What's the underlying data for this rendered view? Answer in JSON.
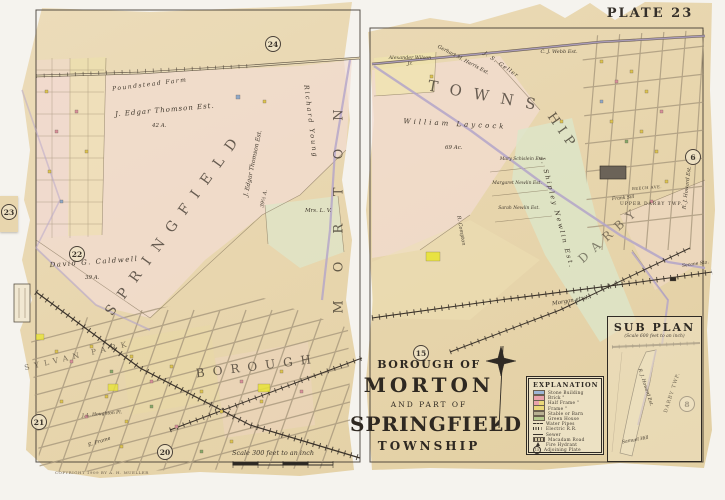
{
  "plate_label": "PLATE 23",
  "adjoining_plates": {
    "top": "24",
    "left_upper": "23",
    "left_mid": "22",
    "left_lower": "21",
    "bottom": "20",
    "center": "15",
    "right": "6",
    "subplan": "8"
  },
  "title_block": {
    "prefix": "BOROUGH OF",
    "name": "MORTON",
    "connector": "AND PART OF",
    "name2": "SPRINGFIELD",
    "suffix": "TOWNSHIP"
  },
  "scale_bar": {
    "label": "Scale 300 feet to an inch"
  },
  "copyright_line": "COPYRIGHT 1909 BY A. H. MUELLER",
  "legend": {
    "title": "EXPLANATION",
    "sample_plate": "15",
    "swatch_colors": {
      "stone": "#9db6d6",
      "brick": "#e9a3ab",
      "frame": "#ead879",
      "stable": "#b9b193",
      "greenhouse": "#b4c98c"
    },
    "rows": [
      {
        "label": "Stone Building"
      },
      {
        "label": "Brick \""
      },
      {
        "label": "Half Frame \""
      },
      {
        "label": "Frame \""
      },
      {
        "label": "Stable or Barn"
      },
      {
        "label": "Green House"
      },
      {
        "label": "Water Pipes"
      },
      {
        "label": "Electric R.R."
      },
      {
        "label": "Sewer"
      },
      {
        "label": "Macadam Road"
      },
      {
        "label": "Fire Hydrant"
      },
      {
        "label": "Adjoining Plate"
      }
    ]
  },
  "sub_plan": {
    "title": "SUB PLAN",
    "subtitle": "(Scale 600 feet to an inch)",
    "labels": {
      "howard": "R. J. Howard Est.",
      "darby": "DARBY TWP.",
      "hill": "Samuel Hill"
    }
  },
  "map_labels": {
    "springfield": "SPRINGFIELD",
    "morton_vertical": "MORTON",
    "borough": "BOROUGH",
    "towns": "TOWNS",
    "hip": "HIP",
    "darby_big": "DARBY",
    "upper_darby": "UPPER DARBY TWP.",
    "poundstead_farm": "Poundstead Farm",
    "thomson_upper": "J. Edgar Thomson Est.",
    "thomson_upper_acreage": "42 A.",
    "thomson_lower": "J. Edgar Thomson Est.",
    "thomson_lower_acreage": "39½ A.",
    "richard_young": "Richard Young",
    "caldwell": "David G. Caldwell",
    "caldwell_acreage": "39 A.",
    "mrs_lv": "Mrs. L. V.",
    "sylvan_park": "SYLVAN PARK",
    "e_frame": "E. Frame",
    "houghton": "J. L. Houghton Pl.",
    "wilson": "Alexander Wilson Jr.",
    "webb": "C. J. Webb Est.",
    "geller": "J. S. Geller",
    "gerhart": "Gerhart M. Harris Est.",
    "laycock": "William Laycock",
    "laycock_acreage": "69 Ac.",
    "schislein": "Mary Schislein Est.",
    "margaret_newlin": "Margaret Newlin Est.",
    "sarah_newlin": "Sarah Newlin Est.",
    "shipley_newlin": "J. Shipley Newlin Est.",
    "howard": "R. J. Howard Est.",
    "frank_sill": "Frank Sill",
    "morgan": "Morgan et al.",
    "compton": "R. Compton",
    "beech_ave": "BEECH AVE.",
    "secane": "Secane Sta."
  }
}
